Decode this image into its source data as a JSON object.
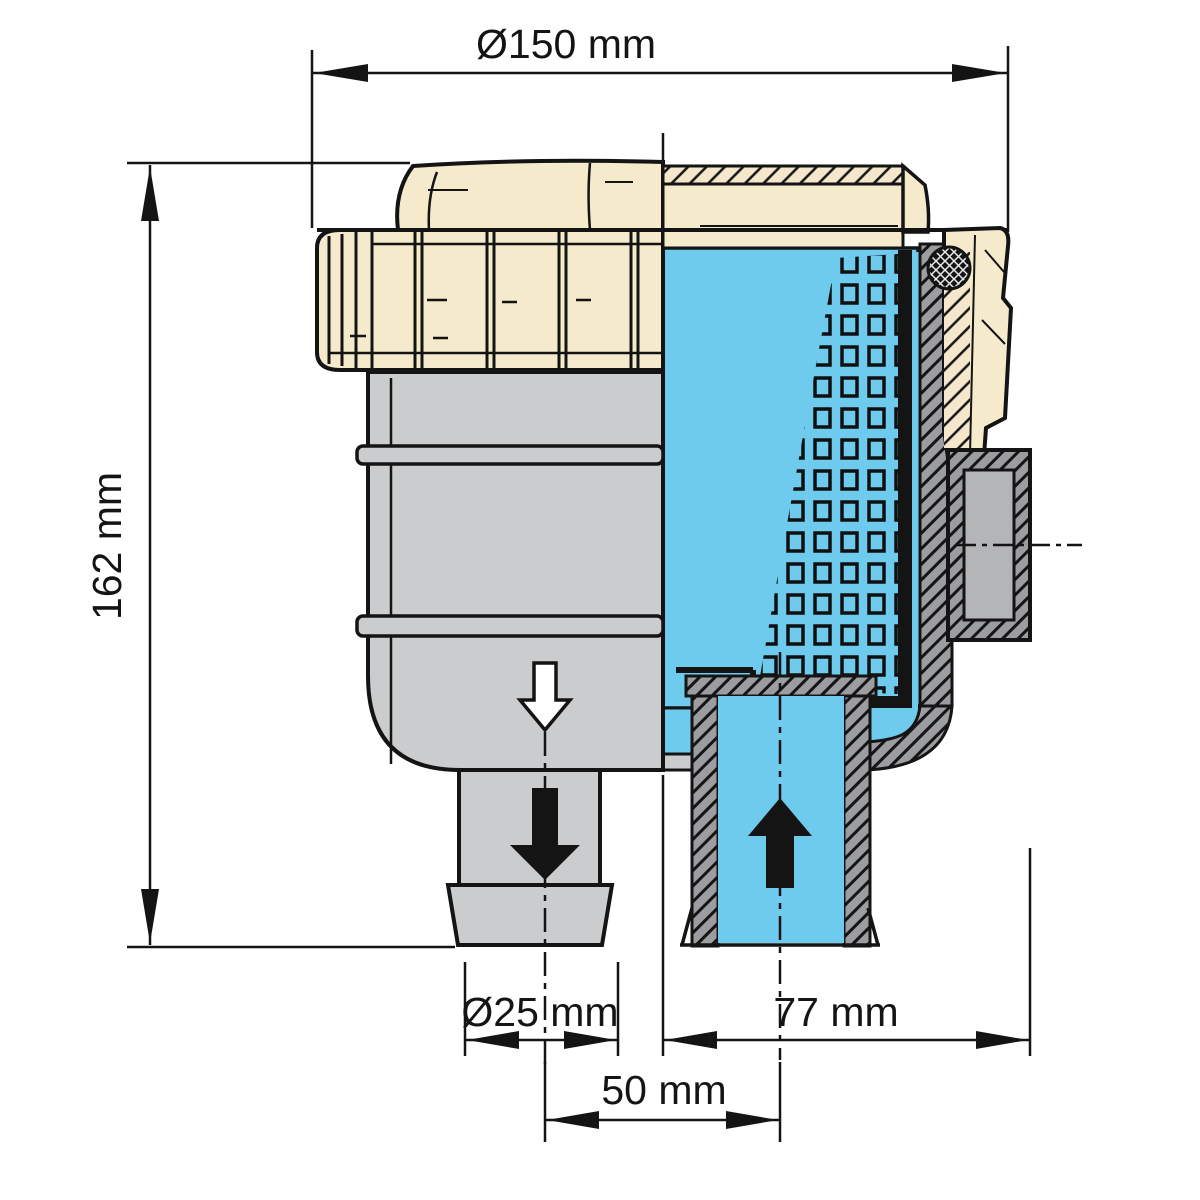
{
  "dimensions": {
    "lid_diameter": "Ø150 mm",
    "overall_height": "162 mm",
    "hose_spigot_diameter": "Ø25 mm",
    "inlet_offset": "77 mm",
    "spigot_spacing": "50 mm"
  },
  "flow": {
    "outlet_direction": "down",
    "inlet_direction": "up"
  },
  "colors": {
    "lid_cream": "#f6eacd",
    "body_gray": "#cbcccd",
    "section_gray": "#9c9da0",
    "port_gray": "#b4b5b7",
    "water_blue": "#6ecbee",
    "line": "#141414"
  }
}
